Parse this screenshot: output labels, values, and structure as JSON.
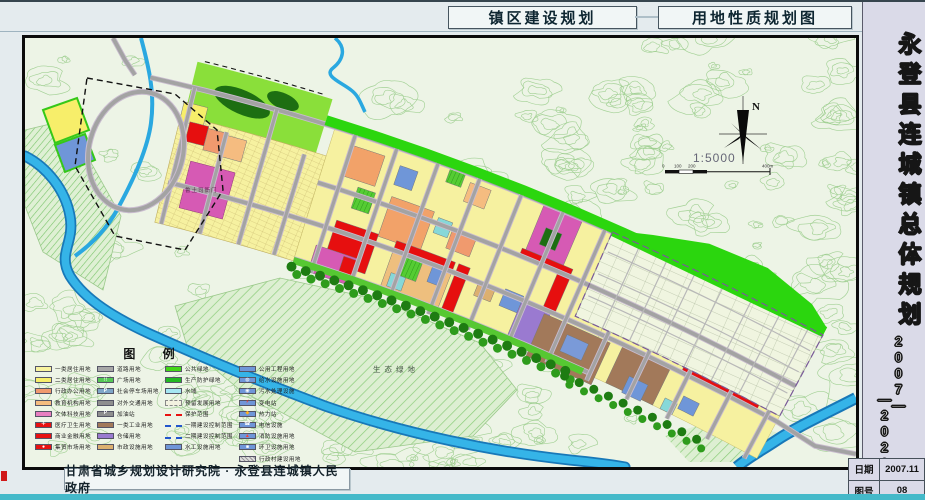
{
  "header": {
    "title_left": "镇区建设规划",
    "title_right": "用地性质规划图"
  },
  "sidebar": {
    "title": "永登县连城镇总体规划",
    "period1": "2007—",
    "period2": "—2020",
    "date_label": "日期",
    "date_value": "2007.11",
    "sheet_label": "图号",
    "sheet_value": "08"
  },
  "footer": {
    "credit": "甘肃省城乡规划设计研究院 · 永登县连城镇人民政府"
  },
  "map": {
    "yamen_label": "鲁土司衙门",
    "eco_label": "生态绿地",
    "north_label": "N",
    "scale_text": "1:5000",
    "scale_marks": [
      "0",
      "100",
      "200",
      "400m"
    ]
  },
  "legend": {
    "title": "图 例",
    "columns": [
      {
        "items": [
          {
            "label": "一类居住用地",
            "color": "#f8f39e",
            "kind": "solid",
            "icon": ""
          },
          {
            "label": "二类居住用地",
            "color": "#f7ee6a",
            "kind": "solid",
            "icon": ""
          },
          {
            "label": "行政办公用地",
            "color": "#f09a6e",
            "kind": "solid",
            "icon": ""
          },
          {
            "label": "教育机构用地",
            "color": "#f5bc80",
            "kind": "solid",
            "icon": ""
          },
          {
            "label": "文体科技用地",
            "color": "#e87fc0",
            "kind": "solid",
            "icon": ""
          },
          {
            "label": "医疗卫生用地",
            "color": "#e81111",
            "kind": "solid",
            "icon": "＋",
            "iconColor": "#ffffff"
          },
          {
            "label": "商业金融用地",
            "color": "#e81111",
            "kind": "solid",
            "icon": ""
          },
          {
            "label": "集贸市场用地",
            "color": "#e81111",
            "kind": "solid",
            "icon": "●",
            "iconColor": "#ffffff"
          }
        ]
      },
      {
        "items": [
          {
            "label": "道路用地",
            "color": "#a8a8a8",
            "kind": "solid",
            "icon": ""
          },
          {
            "label": "广场用地",
            "color": "#55c855",
            "kind": "solid",
            "icon": "∷",
            "iconColor": "#ffffff"
          },
          {
            "label": "社会停车场用地",
            "color": "#7ea6c8",
            "kind": "solid",
            "icon": "P",
            "iconColor": "#ffffff"
          },
          {
            "label": "对外交通用地",
            "color": "#8f8f8f",
            "kind": "solid",
            "icon": ""
          },
          {
            "label": "加油站",
            "color": "#8f8f8f",
            "kind": "solid",
            "icon": "P",
            "iconColor": "#ffffff"
          },
          {
            "label": "一类工业用地",
            "color": "#a2795a",
            "kind": "solid",
            "icon": ""
          },
          {
            "label": "仓储用地",
            "color": "#9a7ad0",
            "kind": "solid",
            "icon": ""
          },
          {
            "label": "市政设施用地",
            "color": "#dcb070",
            "kind": "solid",
            "icon": ""
          }
        ]
      },
      {
        "items": [
          {
            "label": "公共绿地",
            "color": "#42d616",
            "kind": "solid",
            "icon": ""
          },
          {
            "label": "生产防护绿地",
            "color": "#22b822",
            "kind": "solid",
            "icon": ""
          },
          {
            "label": "水域",
            "color": "#a5e6f2",
            "kind": "solid",
            "icon": ""
          },
          {
            "label": "预留发展用地",
            "color": "#f2f2e0",
            "kind": "dashed",
            "icon": ""
          },
          {
            "label": "保护范围",
            "color": "#e81111",
            "kind": "line",
            "icon": ""
          },
          {
            "label": "一期建设控制范围",
            "color": "#2255cc",
            "kind": "line",
            "icon": ""
          },
          {
            "label": "二期建设控制范围",
            "color": "#2255cc",
            "kind": "line",
            "icon": ""
          },
          {
            "label": "水工设施用地",
            "color": "#6f96d8",
            "kind": "solid",
            "icon": ""
          }
        ]
      },
      {
        "items": [
          {
            "label": "公用工程用地",
            "color": "#6f96d8",
            "kind": "solid",
            "icon": ""
          },
          {
            "label": "给水设施用地",
            "color": "#6f96d8",
            "kind": "solid",
            "icon": "◍",
            "iconColor": "#ffffff"
          },
          {
            "label": "污水处理设施",
            "color": "#6f96d8",
            "kind": "solid",
            "icon": "◉",
            "iconColor": "#ffffff"
          },
          {
            "label": "变电站",
            "color": "#6f96d8",
            "kind": "solid",
            "icon": "⚡",
            "iconColor": "#ff3020"
          },
          {
            "label": "热力站",
            "color": "#6f96d8",
            "kind": "solid",
            "icon": "◆",
            "iconColor": "#ffb020"
          },
          {
            "label": "电信设施",
            "color": "#6f96d8",
            "kind": "solid",
            "icon": "☎",
            "iconColor": "#ffffff"
          },
          {
            "label": "消防设施用地",
            "color": "#6f96d8",
            "kind": "solid",
            "icon": "▲",
            "iconColor": "#ff4030"
          },
          {
            "label": "环卫设施用地",
            "color": "#6f96d8",
            "kind": "solid",
            "icon": "■",
            "iconColor": "#ffffff"
          },
          {
            "label": "行政村建设用地",
            "color": "#cccccc",
            "kind": "hatch",
            "icon": ""
          }
        ]
      }
    ]
  },
  "palette": {
    "topoBg": "#edf4e6",
    "contour": "#9bcd8d",
    "residential": "#f6f1a0",
    "residential2": "#f7ee6a",
    "admin": "#f09a6e",
    "education": "#f2a269",
    "edu2": "#f5bc80",
    "culture": "#d65ab4",
    "commercial": "#e60f0f",
    "industry": "#a2795a",
    "warehouse": "#9a7ad0",
    "municipal": "#6f96d8",
    "municipal2": "#7a9ad8",
    "cyanUtil": "#86d8d8",
    "tan": "#dcb070",
    "tanOrange": "#eebf7e",
    "sports": "#55cc33",
    "green": "#2bd60e",
    "lime": "#8adf3a",
    "southStrip": "#56c832",
    "darkgreen": "#1e7c12",
    "treegreen": "#2e9c1c",
    "forest": "#1d6e12",
    "water": "#35b4e8",
    "waterDark": "#1878b8",
    "road": "#a3a3a3",
    "roadCase": "#c9bccf",
    "reserve": "#f0f5e0",
    "oldtownStroke": "#bfae60"
  }
}
